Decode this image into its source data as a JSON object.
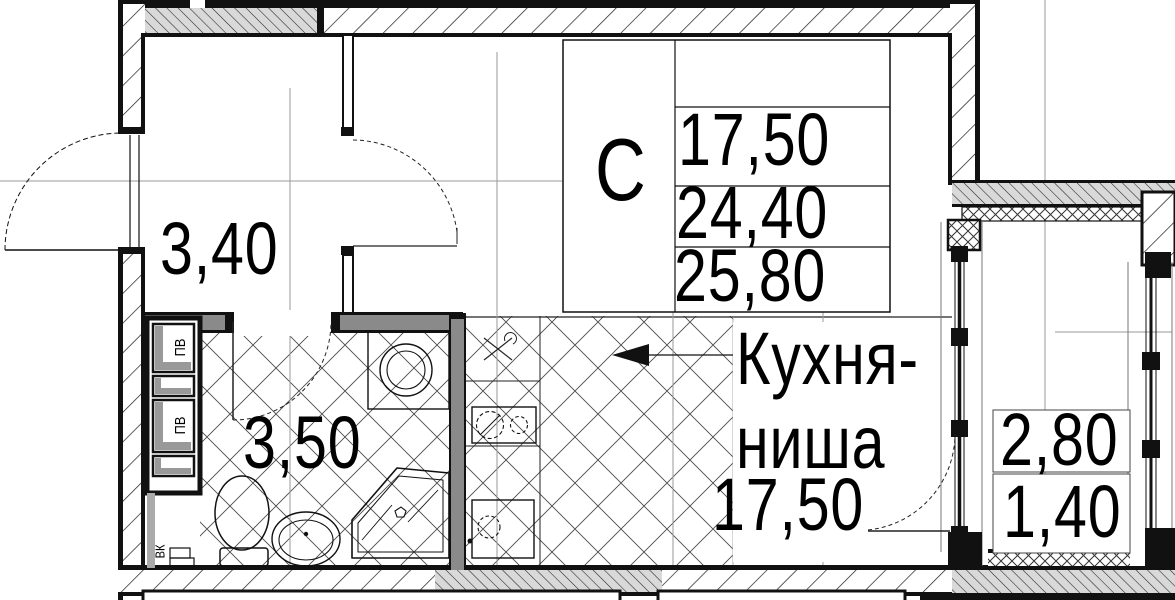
{
  "plan": {
    "title": "studio-apartment-floor-plan",
    "unit_type_label": "С",
    "area_table": {
      "living_area": "17,50",
      "total_area": "24,40",
      "total_area_with_balcony": "25,80"
    },
    "rooms": {
      "hallway": {
        "area": "3,40"
      },
      "bathroom": {
        "area": "3,50"
      },
      "kitchen": {
        "name_line1": "Кухня-",
        "name_line2": "ниша",
        "area": "17,50"
      },
      "balcony": {
        "area": "2,80",
        "area_reduced": "1,40"
      }
    },
    "shafts": {
      "vent_shaft_1": "ПВ",
      "vent_shaft_2": "ПВ",
      "water_shaft": "ВК"
    },
    "colors": {
      "ink": "#111111",
      "wall_gray": "#8a8a8a",
      "poche_gray": "#d9d9d9",
      "axis_gray": "#9a9a9a",
      "hatch_floor": "#4a4a4a"
    }
  }
}
